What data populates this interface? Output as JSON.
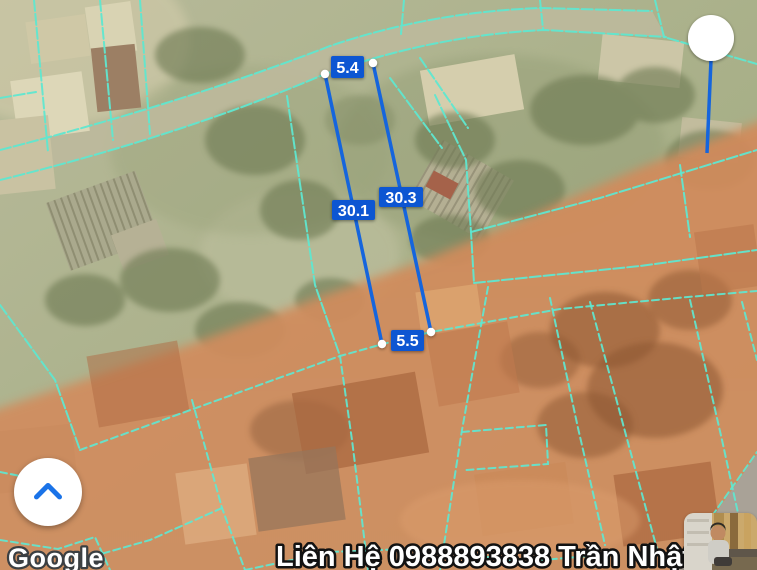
{
  "attribution": {
    "logo_text": "Google"
  },
  "contact_overlay": {
    "text": "Liên Hệ 0988893838 Trần Nhật"
  },
  "measurements": {
    "top": "5.4",
    "left": "30.1",
    "right": "30.3",
    "bottom": "5.5"
  },
  "controls": {
    "collapse_button": {
      "icon": "chevron-up-icon"
    }
  },
  "map": {
    "view": "satellite",
    "overlay_colors": {
      "parcel_lines": "#5fe7d0",
      "planning_zone": "#d0855a",
      "measure_line": "#1565dd",
      "measure_label_bg": "#1156d2",
      "chevron_blue": "#1a73e8"
    },
    "markers": {
      "active_point": "white-circle-marker",
      "measure_endpoint": "white-dot-marker"
    }
  },
  "avatar": {
    "type": "profile-photo"
  }
}
